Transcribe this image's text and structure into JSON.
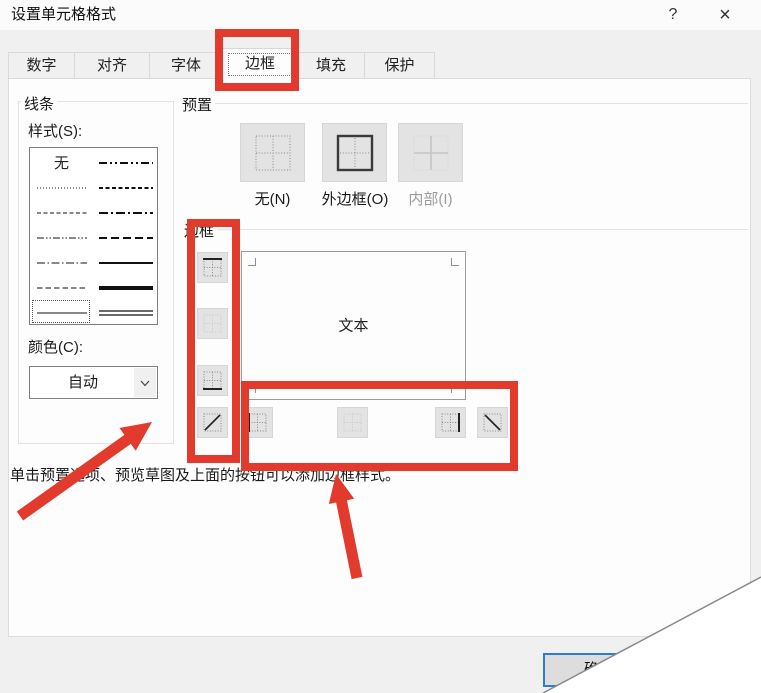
{
  "window": {
    "title": "设置单元格格式",
    "help_glyph": "?",
    "close_glyph": "×"
  },
  "tabs": {
    "selected": "边框",
    "items": [
      {
        "label": "数字"
      },
      {
        "label": "对齐"
      },
      {
        "label": "字体"
      },
      {
        "label": "边框"
      },
      {
        "label": "填充"
      },
      {
        "label": "保护"
      }
    ]
  },
  "line": {
    "group_title": "线条",
    "style_label": "样式(S):",
    "none_option": "无",
    "color_label": "颜色(C):",
    "color_value": "自动"
  },
  "presets": {
    "group_title": "预置",
    "none_label": "无(N)",
    "outline_label": "外边框(O)",
    "inside_label": "内部(I)"
  },
  "border": {
    "group_title": "边框",
    "preview_text": "文本"
  },
  "help_text": "单击预置选项、预览草图及上面的按钮可以添加边框样式。",
  "footer": {
    "ok_label": "确定"
  },
  "colors": {
    "annotation_red": "#e23b2e",
    "ok_button_border": "#2a7cd4",
    "dialog_background": "#f0f0f0",
    "tabpage_background": "#fdfdfd"
  }
}
